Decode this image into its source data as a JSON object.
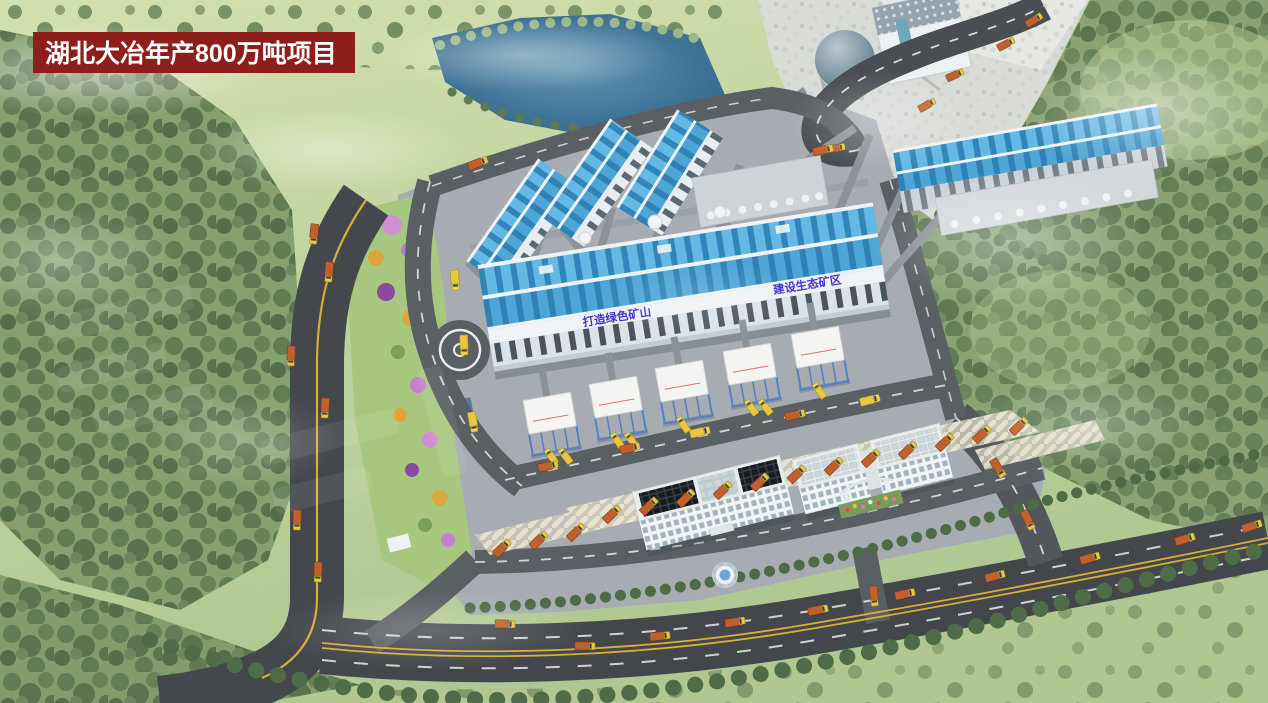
{
  "scene": {
    "description": "aerial-3d-render-of-aggregate-plant",
    "banner": {
      "text": "湖北大冶年产800万吨项目",
      "bg_color": "#8e1e1c",
      "text_color": "#ffffff"
    },
    "slogans": {
      "left": "打造绿色矿山",
      "right": "建设生态矿区",
      "color": "#4433cc"
    },
    "palette": {
      "grass_light": "#ccdcaa",
      "grass_dark": "#b3c994",
      "forest_green": "#5d7a52",
      "public_road": "#43474c",
      "internal_road": "#5a5f64",
      "pavement_gray": "#a6acb2",
      "pond_blue": "#3f7396",
      "roof_blue": "#58b0de",
      "roof_rib_blue": "#2a7cb0",
      "facade_white": "#eef2f5",
      "truck_orange": "#c2602d",
      "truck_yellow": "#e9c83e",
      "lane_yellow": "#d9ae35",
      "quarry_gray": "#d9dbd7",
      "silo_frame_blue": "#5580c5"
    }
  }
}
